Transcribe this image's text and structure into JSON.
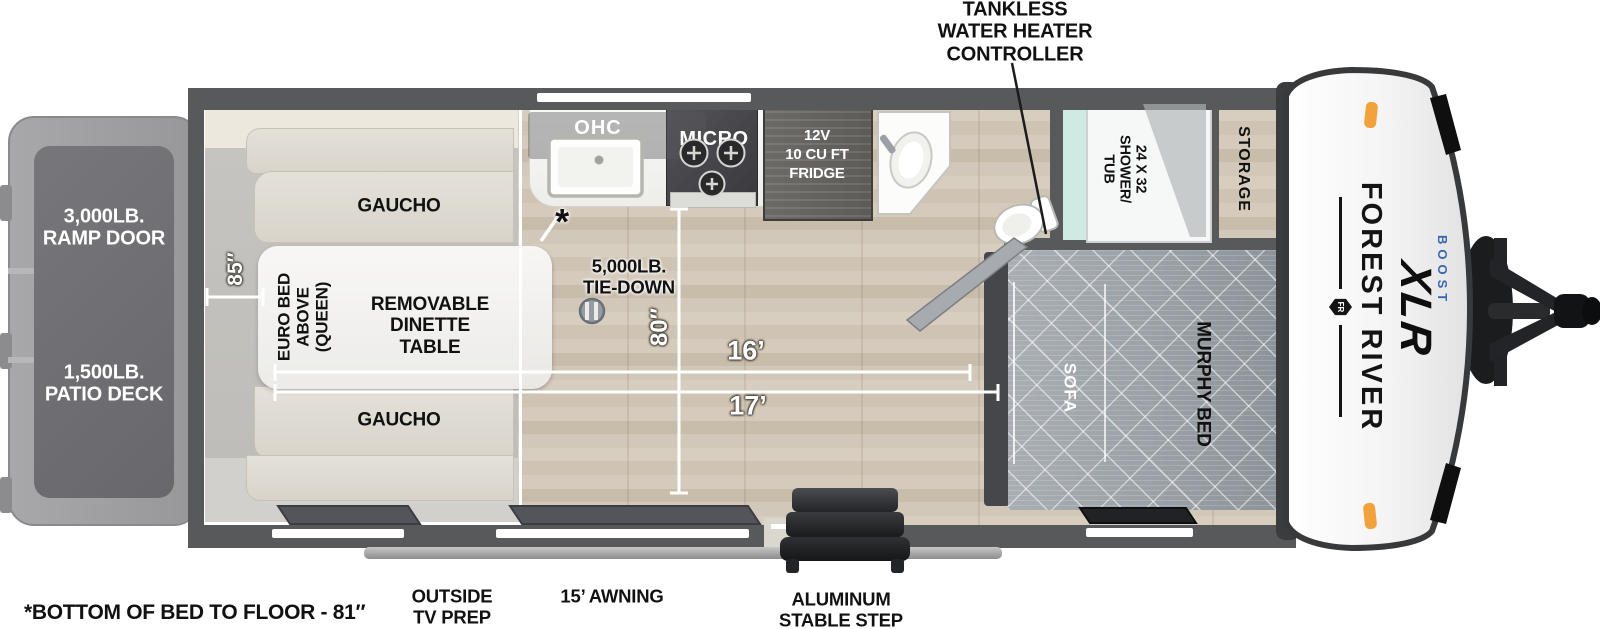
{
  "callout_top": {
    "lines": [
      "TANKLESS",
      "WATER HEATER",
      "CONTROLLER"
    ]
  },
  "exterior": {
    "ramp_door": {
      "lines": [
        "3,000LB.",
        "RAMP DOOR"
      ]
    },
    "patio_deck": {
      "lines": [
        "1,500LB.",
        "PATIO DECK"
      ]
    }
  },
  "rooms": {
    "gaucho_top": "GAUCHO",
    "gaucho_bottom": "GAUCHO",
    "euro_bed": {
      "lines": [
        "EURO BED",
        "ABOVE",
        "(QUEEN)"
      ]
    },
    "dinette": {
      "lines": [
        "REMOVABLE",
        "DINETTE",
        "TABLE"
      ]
    },
    "ohc": "OHC",
    "micro": "MICRO",
    "fridge": {
      "lines": [
        "12V",
        "10 CU FT",
        "FRIDGE"
      ]
    },
    "tie_down": {
      "lines": [
        "5,000LB.",
        "TIE-DOWN"
      ]
    },
    "shower": {
      "lines": [
        "24 X 32",
        "SHOWER/",
        "TUB"
      ]
    },
    "storage": "STORAGE",
    "sofa": "SOFA",
    "murphy_bed": "MURPHY BED"
  },
  "dimensions": {
    "bed_length": "85″",
    "garage_width": "80″",
    "len_16": "16’",
    "len_17": "17’",
    "asterisk": "*"
  },
  "callouts_bottom": {
    "bed_note": "*BOTTOM OF BED TO FLOOR - 81″",
    "tv_prep": {
      "lines": [
        "OUTSIDE",
        "TV PREP"
      ]
    },
    "awning": "15’ AWNING",
    "step": {
      "lines": [
        "ALUMINUM",
        "STABLE STEP"
      ]
    }
  },
  "brand": {
    "name": "FOREST RIVER",
    "model": "XLR",
    "trim": "BOOST",
    "emblem": "FR"
  },
  "colors": {
    "wall": "#58595b",
    "shower_teal": "#cfe9e3",
    "marker_orange": "#f2a23c",
    "boost_blue": "#3a66b0"
  }
}
